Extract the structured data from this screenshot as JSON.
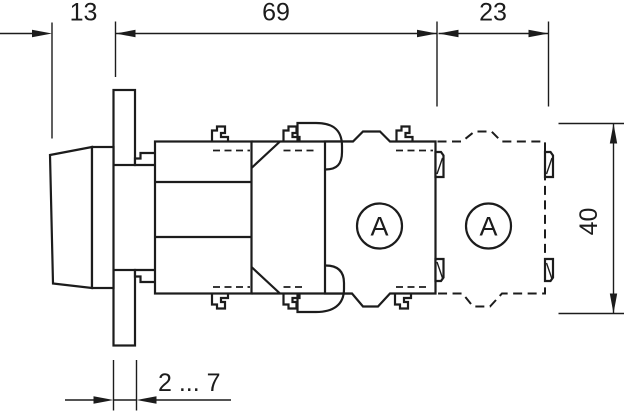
{
  "diagram": {
    "type": "dimension-drawing",
    "subject": "panel-mounted pushbutton with two contact blocks, side view",
    "colors": {
      "line": "#1c1c1c",
      "background": "#ffffff"
    },
    "dimensions": {
      "top_left": "13",
      "top_middle": "69",
      "top_right": "23",
      "right_vertical": "40",
      "panel_thickness": "2 ... 7"
    },
    "contact_blocks": {
      "block1_label": "A",
      "block2_label": "A"
    }
  }
}
